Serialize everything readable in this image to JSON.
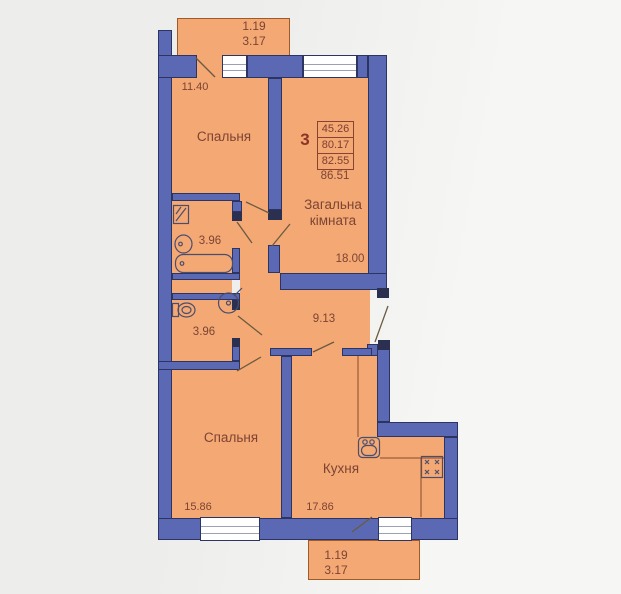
{
  "colors": {
    "wall": "#5b69b5",
    "wall_outline": "#2c3462",
    "floor": "#f4a873",
    "floor_outline": "#a05a28",
    "background": "#f2f2f0",
    "ink": "#7c4434",
    "frame": "#2b3050",
    "fixture": "#4a4e6e",
    "door_line": "#6b5a40"
  },
  "balcony_top": {
    "line1": "1.19",
    "line2": "3.17"
  },
  "balcony_bottom": {
    "line1": "1.19",
    "line2": "3.17"
  },
  "info_box": {
    "rooms_count": "3",
    "areas": [
      "45.26",
      "80.17",
      "82.55"
    ],
    "total": "86.51"
  },
  "rooms": {
    "bedroom1": {
      "name": "Спальня",
      "area": "11.40"
    },
    "living": {
      "name_line1": "Загальна",
      "name_line2": "кімната",
      "area": "18.00"
    },
    "bathroom": {
      "area": "3.96"
    },
    "wc": {
      "area": "3.96"
    },
    "hall": {
      "area": "9.13"
    },
    "bedroom2": {
      "name": "Спальня",
      "area": "15.86"
    },
    "kitchen": {
      "name": "Кухня",
      "area": "17.86"
    }
  }
}
